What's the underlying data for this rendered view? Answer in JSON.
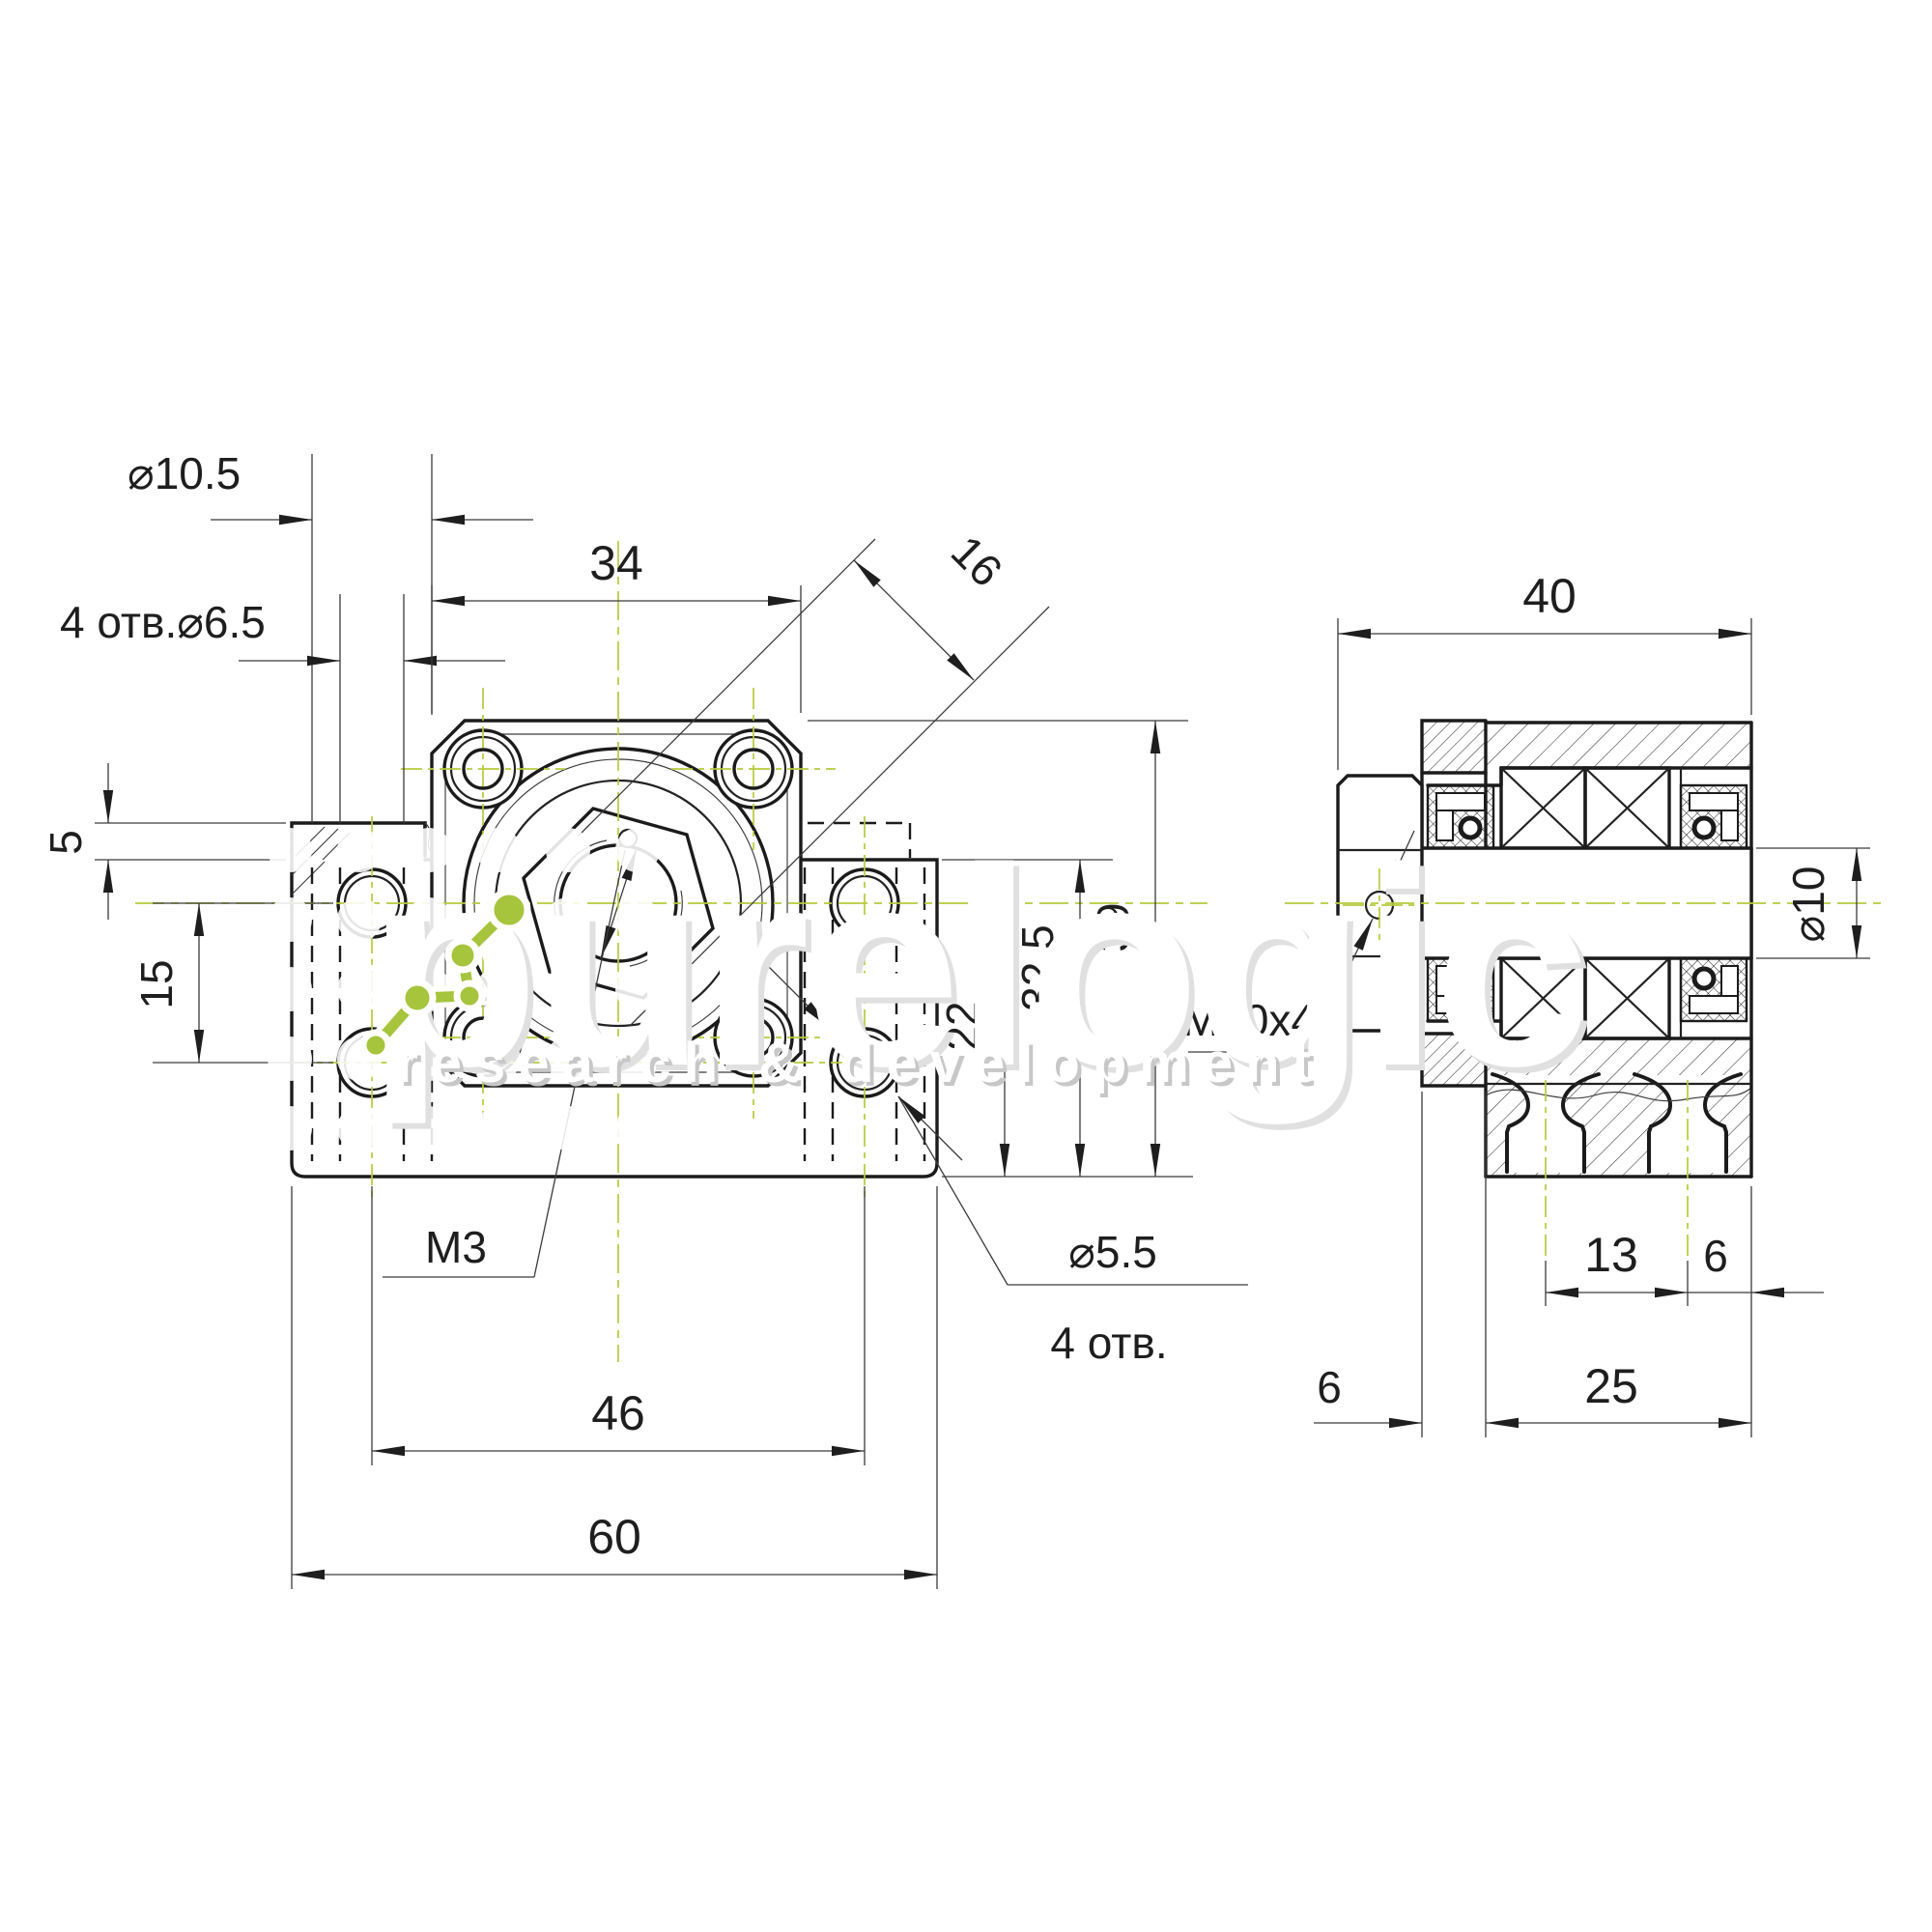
{
  "front": {
    "dia_counterbore": "⌀10.5",
    "holes_base": "4 отв.⌀6.5",
    "flange_width": "34",
    "nut_flats": "16",
    "step_height": "5",
    "hole_pitch_vert": "15",
    "set_screw": "M3",
    "hole_pitch_horiz": "46",
    "base_width": "60",
    "dia_face_holes": "⌀5.5",
    "face_holes_count": "4 отв.",
    "center_height": "22",
    "body_height": "32.5",
    "total_height": "39"
  },
  "side": {
    "total_depth": "40",
    "shaft_dia": "⌀10",
    "locknut_thread": "M10x4",
    "slot_pitch": "13",
    "slot_to_face": "6",
    "body_depth": "25",
    "flange_thickness": "6"
  },
  "watermark": {
    "brand": "purelogic",
    "tagline": "research & development"
  },
  "colors": {
    "centerline_green": "#b8c93e",
    "logo_green": "#a6c43c",
    "line_black": "#1b1b1b"
  }
}
